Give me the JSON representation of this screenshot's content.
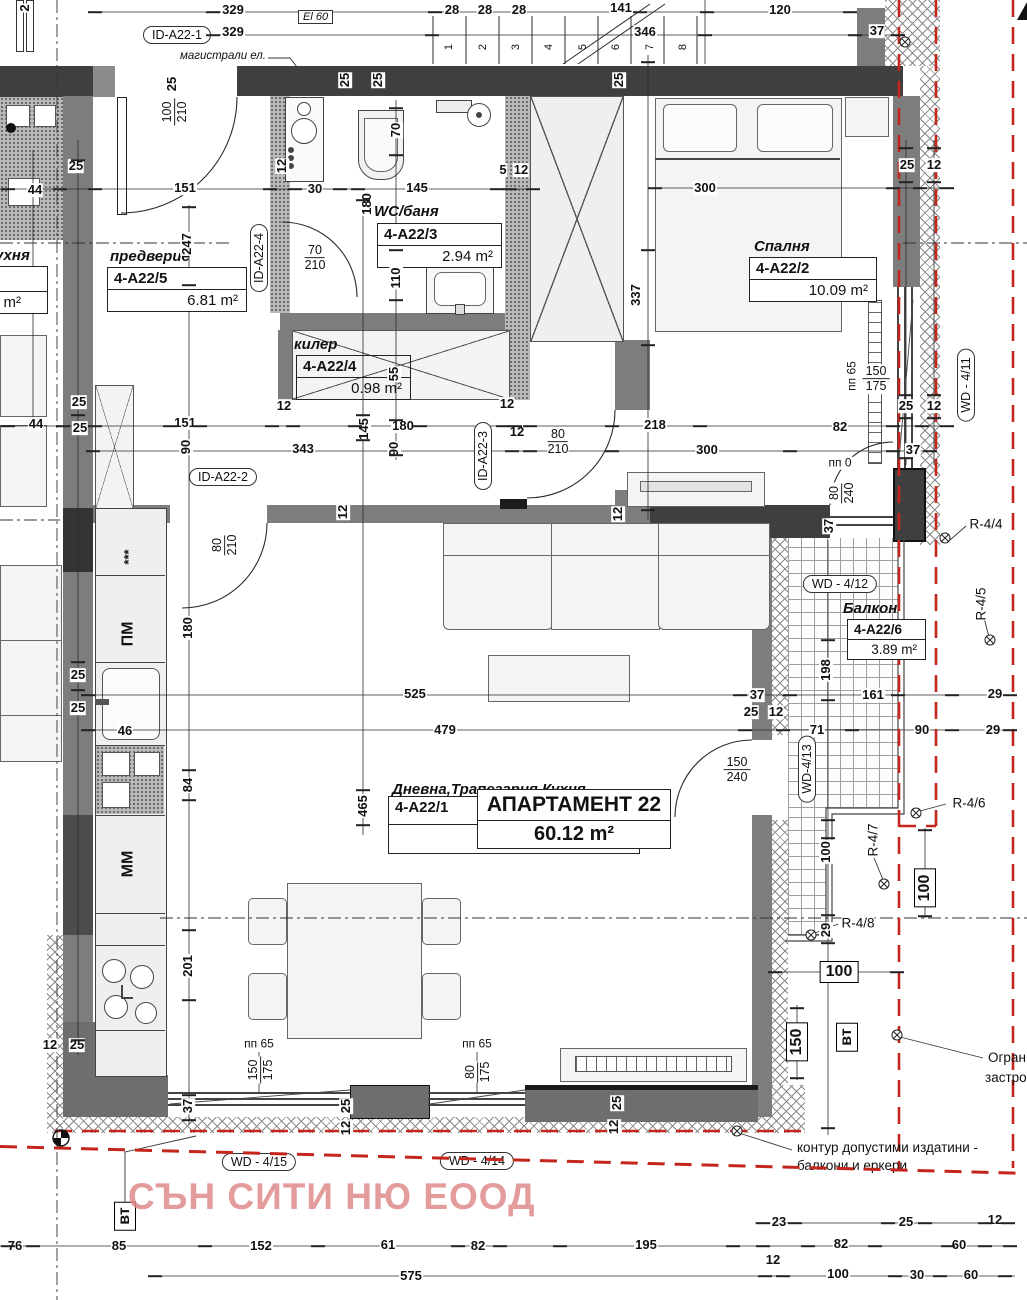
{
  "watermark": "СЪН СИТИ НЮ ЕООД",
  "apartment": {
    "title": "АПАРТАМЕНТ 22",
    "area": "60.12 m²",
    "id": "4-A22/1"
  },
  "rooms": [
    {
      "name": "предверие",
      "id": "4-A22/5",
      "area": "6.81 m²"
    },
    {
      "name": "WC/баня",
      "id": "4-A22/3",
      "area": "2.94 m²"
    },
    {
      "name": "килер",
      "id": "4-A22/4",
      "area": "0.98 m²"
    },
    {
      "name": "Спалня",
      "id": "4-A22/2",
      "area": "10.09 m²"
    },
    {
      "name": "Балкон",
      "id": "4-A22/6",
      "area": "3.89 m²"
    },
    {
      "name": "Дневна,Трапезария,Кухня",
      "id": "4-A22/1",
      "area": ""
    }
  ],
  "neighbor": {
    "name": "Кухня",
    "area": "8 m²"
  },
  "notes": {
    "mains": "магистрали ел.",
    "el": "El 60",
    "contour1": "контур допустими издатини -",
    "contour2": "балкони и еркери",
    "limit1": "Огран",
    "limit2": "застро"
  },
  "colors": {
    "red_boundary": "#c4251d",
    "watermark_pink": "#de8a8a",
    "wall_dark": "#3f3f3f",
    "wall_mid": "#7d7d7d"
  },
  "stairs": {
    "labels": [
      "1",
      "2",
      "3",
      "4",
      "5",
      "6",
      "7",
      "8"
    ],
    "xs": [
      449,
      483,
      516,
      549,
      583,
      616,
      650,
      683
    ],
    "y": 47
  },
  "ovals": [
    {
      "t": "ID-A22-1",
      "x": 177,
      "y": 35
    },
    {
      "t": "ID-A22-2",
      "x": 223,
      "y": 477
    },
    {
      "t": "ID-A22-3",
      "x": 483,
      "y": 456,
      "r": -90
    },
    {
      "t": "ID-A22-4",
      "x": 259,
      "y": 258,
      "r": -90
    },
    {
      "t": "WD - 4/11",
      "x": 966,
      "y": 385,
      "r": -90
    },
    {
      "t": "WD - 4/12",
      "x": 840,
      "y": 584
    },
    {
      "t": "WD-4/13",
      "x": 807,
      "y": 769,
      "r": -90
    },
    {
      "t": "WD - 4/15",
      "x": 259,
      "y": 1162
    },
    {
      "t": "WD - 4/14",
      "x": 477,
      "y": 1161
    }
  ],
  "rmarks": [
    {
      "t": "R-4/4",
      "x": 986,
      "y": 524
    },
    {
      "t": "R-4/5",
      "x": 981,
      "y": 604,
      "r": -90
    },
    {
      "t": "R-4/6",
      "x": 969,
      "y": 803
    },
    {
      "t": "R-4/7",
      "x": 873,
      "y": 840,
      "r": -90
    },
    {
      "t": "R-4/8",
      "x": 858,
      "y": 923
    }
  ],
  "boxes": [
    {
      "t": "100",
      "x": 925,
      "y": 888,
      "r": -90
    },
    {
      "t": "100",
      "x": 839,
      "y": 972
    },
    {
      "t": "150",
      "x": 797,
      "y": 1042,
      "r": -90
    },
    {
      "t": "вт",
      "x": 847,
      "y": 1037,
      "r": -90
    },
    {
      "t": "вт",
      "x": 125,
      "y": 1216,
      "r": -90
    }
  ],
  "fracs": [
    {
      "a": "100",
      "b": "210",
      "x": 175,
      "y": 112,
      "r": -90
    },
    {
      "a": "70",
      "b": "210",
      "x": 315,
      "y": 258
    },
    {
      "a": "80",
      "b": "210",
      "x": 225,
      "y": 545,
      "r": -90
    },
    {
      "a": "80",
      "b": "210",
      "x": 558,
      "y": 442
    },
    {
      "a": "80",
      "b": "240",
      "x": 842,
      "y": 493,
      "r": -90
    },
    {
      "a": "150",
      "b": "175",
      "x": 876,
      "y": 379
    },
    {
      "a": "150",
      "b": "240",
      "x": 737,
      "y": 770
    },
    {
      "a": "150",
      "b": "175",
      "x": 261,
      "y": 1070,
      "r": -90
    },
    {
      "a": "80",
      "b": "175",
      "x": 478,
      "y": 1072,
      "r": -90
    }
  ],
  "dims": [
    {
      "t": "329",
      "x": 233,
      "y": 10
    },
    {
      "t": "329",
      "x": 233,
      "y": 32
    },
    {
      "t": "28",
      "x": 452,
      "y": 10
    },
    {
      "t": "28",
      "x": 485,
      "y": 10
    },
    {
      "t": "28",
      "x": 519,
      "y": 10
    },
    {
      "t": "141",
      "x": 621,
      "y": 8
    },
    {
      "t": "346",
      "x": 645,
      "y": 32
    },
    {
      "t": "120",
      "x": 780,
      "y": 10
    },
    {
      "t": "37",
      "x": 877,
      "y": 31
    },
    {
      "t": "2",
      "x": 25,
      "y": 8,
      "r": -90
    },
    {
      "t": "25",
      "x": 172,
      "y": 84,
      "r": -90
    },
    {
      "t": "25",
      "x": 619,
      "y": 80,
      "r": -90
    },
    {
      "t": "25",
      "x": 345,
      "y": 80,
      "r": -90
    },
    {
      "t": "25",
      "x": 378,
      "y": 80,
      "r": -90
    },
    {
      "t": "70",
      "x": 396,
      "y": 130,
      "r": -90
    },
    {
      "t": "110",
      "x": 396,
      "y": 278,
      "r": -90
    },
    {
      "t": "25",
      "x": 76,
      "y": 166
    },
    {
      "t": "44",
      "x": 35,
      "y": 190
    },
    {
      "t": "151",
      "x": 185,
      "y": 188
    },
    {
      "t": "12",
      "x": 282,
      "y": 166,
      "r": -90
    },
    {
      "t": "30",
      "x": 315,
      "y": 189
    },
    {
      "t": "180",
      "x": 367,
      "y": 204,
      "r": -90
    },
    {
      "t": "145",
      "x": 417,
      "y": 188
    },
    {
      "t": "5",
      "x": 503,
      "y": 170
    },
    {
      "t": "12",
      "x": 521,
      "y": 170
    },
    {
      "t": "247",
      "x": 187,
      "y": 244,
      "r": -90
    },
    {
      "t": "300",
      "x": 705,
      "y": 188
    },
    {
      "t": "25",
      "x": 907,
      "y": 165
    },
    {
      "t": "12",
      "x": 934,
      "y": 165
    },
    {
      "t": "337",
      "x": 636,
      "y": 295,
      "r": -90
    },
    {
      "t": "55",
      "x": 394,
      "y": 374,
      "r": -90
    },
    {
      "t": "12",
      "x": 284,
      "y": 406
    },
    {
      "t": "44",
      "x": 36,
      "y": 424
    },
    {
      "t": "25",
      "x": 79,
      "y": 402
    },
    {
      "t": "25",
      "x": 80,
      "y": 428
    },
    {
      "t": "151",
      "x": 185,
      "y": 423
    },
    {
      "t": "90",
      "x": 186,
      "y": 447,
      "r": -90
    },
    {
      "t": "343",
      "x": 303,
      "y": 449
    },
    {
      "t": "145",
      "x": 364,
      "y": 429,
      "r": -90
    },
    {
      "t": "180",
      "x": 403,
      "y": 426
    },
    {
      "t": "90",
      "x": 394,
      "y": 449,
      "r": -90
    },
    {
      "t": "12",
      "x": 507,
      "y": 404
    },
    {
      "t": "12",
      "x": 517,
      "y": 432
    },
    {
      "t": "218",
      "x": 655,
      "y": 425
    },
    {
      "t": "300",
      "x": 707,
      "y": 450
    },
    {
      "t": "82",
      "x": 840,
      "y": 427
    },
    {
      "t": "25",
      "x": 906,
      "y": 406
    },
    {
      "t": "12",
      "x": 934,
      "y": 406
    },
    {
      "t": "37",
      "x": 913,
      "y": 450
    },
    {
      "t": "пп 0",
      "x": 840,
      "y": 463,
      "s": 1
    },
    {
      "t": "37",
      "x": 829,
      "y": 526,
      "r": -90
    },
    {
      "t": "пп 65",
      "x": 852,
      "y": 376,
      "r": -90,
      "s": 1
    },
    {
      "t": "12",
      "x": 343,
      "y": 512,
      "r": -90
    },
    {
      "t": "12",
      "x": 618,
      "y": 514,
      "r": -90
    },
    {
      "t": "180",
      "x": 188,
      "y": 628,
      "r": -90
    },
    {
      "t": "25",
      "x": 78,
      "y": 675
    },
    {
      "t": "25",
      "x": 78,
      "y": 708
    },
    {
      "t": "46",
      "x": 125,
      "y": 731
    },
    {
      "t": "84",
      "x": 188,
      "y": 785,
      "r": -90
    },
    {
      "t": "201",
      "x": 188,
      "y": 966,
      "r": -90
    },
    {
      "t": "525",
      "x": 415,
      "y": 694
    },
    {
      "t": "479",
      "x": 445,
      "y": 730
    },
    {
      "t": "465",
      "x": 363,
      "y": 806,
      "r": -90
    },
    {
      "t": "37",
      "x": 757,
      "y": 695
    },
    {
      "t": "25",
      "x": 751,
      "y": 712
    },
    {
      "t": "12",
      "x": 776,
      "y": 712
    },
    {
      "t": "161",
      "x": 873,
      "y": 695
    },
    {
      "t": "29",
      "x": 995,
      "y": 694
    },
    {
      "t": "71",
      "x": 817,
      "y": 730
    },
    {
      "t": "90",
      "x": 922,
      "y": 730
    },
    {
      "t": "29",
      "x": 993,
      "y": 730
    },
    {
      "t": "198",
      "x": 826,
      "y": 670,
      "r": -90
    },
    {
      "t": "100",
      "x": 826,
      "y": 852,
      "r": -90
    },
    {
      "t": "29",
      "x": 826,
      "y": 930,
      "r": -90
    },
    {
      "t": "12",
      "x": 50,
      "y": 1045
    },
    {
      "t": "25",
      "x": 77,
      "y": 1045
    },
    {
      "t": "37",
      "x": 188,
      "y": 1106,
      "r": -90
    },
    {
      "t": "пп 65",
      "x": 259,
      "y": 1044,
      "s": 1
    },
    {
      "t": "пп 65",
      "x": 477,
      "y": 1044,
      "s": 1
    },
    {
      "t": "25",
      "x": 346,
      "y": 1106,
      "r": -90
    },
    {
      "t": "12",
      "x": 346,
      "y": 1128,
      "r": -90
    },
    {
      "t": "25",
      "x": 617,
      "y": 1103,
      "r": -90
    },
    {
      "t": "12",
      "x": 614,
      "y": 1127,
      "r": -90
    },
    {
      "t": "23",
      "x": 779,
      "y": 1222
    },
    {
      "t": "25",
      "x": 906,
      "y": 1222
    },
    {
      "t": "12",
      "x": 995,
      "y": 1220
    },
    {
      "t": "76",
      "x": 15,
      "y": 1246
    },
    {
      "t": "85",
      "x": 119,
      "y": 1246
    },
    {
      "t": "152",
      "x": 261,
      "y": 1246
    },
    {
      "t": "61",
      "x": 388,
      "y": 1245
    },
    {
      "t": "82",
      "x": 478,
      "y": 1246
    },
    {
      "t": "195",
      "x": 646,
      "y": 1245
    },
    {
      "t": "12",
      "x": 773,
      "y": 1260
    },
    {
      "t": "82",
      "x": 841,
      "y": 1244
    },
    {
      "t": "60",
      "x": 959,
      "y": 1245
    },
    {
      "t": "575",
      "x": 411,
      "y": 1276
    },
    {
      "t": "100",
      "x": 838,
      "y": 1274
    },
    {
      "t": "30",
      "x": 917,
      "y": 1275
    },
    {
      "t": "60",
      "x": 971,
      "y": 1275
    }
  ],
  "ticks": [
    [
      95,
      12
    ],
    [
      213,
      12
    ],
    [
      435,
      12
    ],
    [
      640,
      12
    ],
    [
      707,
      12
    ],
    [
      850,
      12
    ],
    [
      213,
      35
    ],
    [
      432,
      35
    ],
    [
      705,
      35
    ],
    [
      855,
      35
    ],
    [
      898,
      35
    ],
    [
      8,
      189
    ],
    [
      60,
      189
    ],
    [
      95,
      189
    ],
    [
      270,
      189
    ],
    [
      295,
      189
    ],
    [
      340,
      189
    ],
    [
      358,
      189
    ],
    [
      497,
      189
    ],
    [
      510,
      189
    ],
    [
      533,
      189
    ],
    [
      655,
      188
    ],
    [
      893,
      188
    ],
    [
      920,
      188
    ],
    [
      947,
      188
    ],
    [
      8,
      426
    ],
    [
      63,
      426
    ],
    [
      95,
      426
    ],
    [
      170,
      426
    ],
    [
      200,
      426
    ],
    [
      272,
      426
    ],
    [
      293,
      426
    ],
    [
      355,
      426
    ],
    [
      420,
      426
    ],
    [
      503,
      426
    ],
    [
      515,
      426
    ],
    [
      530,
      426
    ],
    [
      612,
      426
    ],
    [
      700,
      426
    ],
    [
      893,
      426
    ],
    [
      922,
      426
    ],
    [
      947,
      426
    ],
    [
      93,
      451
    ],
    [
      512,
      451
    ],
    [
      530,
      451
    ],
    [
      612,
      451
    ],
    [
      790,
      451
    ],
    [
      893,
      451
    ],
    [
      930,
      451
    ],
    [
      88,
      695
    ],
    [
      740,
      695
    ],
    [
      790,
      695
    ],
    [
      898,
      695
    ],
    [
      952,
      695
    ],
    [
      1010,
      695
    ],
    [
      88,
      730
    ],
    [
      745,
      730
    ],
    [
      783,
      730
    ],
    [
      852,
      730
    ],
    [
      952,
      730
    ],
    [
      1010,
      730
    ],
    [
      763,
      1223
    ],
    [
      795,
      1223
    ],
    [
      888,
      1223
    ],
    [
      925,
      1223
    ],
    [
      985,
      1223
    ],
    [
      1008,
      1223
    ],
    [
      8,
      1246
    ],
    [
      33,
      1246
    ],
    [
      205,
      1246
    ],
    [
      318,
      1246
    ],
    [
      458,
      1246
    ],
    [
      500,
      1246
    ],
    [
      560,
      1246
    ],
    [
      733,
      1246
    ],
    [
      763,
      1246
    ],
    [
      808,
      1246
    ],
    [
      875,
      1246
    ],
    [
      948,
      1246
    ],
    [
      985,
      1246
    ],
    [
      1010,
      1246
    ],
    [
      155,
      1276
    ],
    [
      765,
      1276
    ],
    [
      783,
      1276
    ],
    [
      895,
      1276
    ],
    [
      940,
      1276
    ],
    [
      1005,
      1276
    ],
    [
      78,
      160
    ],
    [
      78,
      415
    ],
    [
      78,
      662
    ],
    [
      78,
      690
    ],
    [
      78,
      1040
    ],
    [
      189,
      207
    ],
    [
      189,
      285
    ],
    [
      189,
      770
    ],
    [
      189,
      800
    ],
    [
      189,
      930
    ],
    [
      189,
      1000
    ],
    [
      189,
      1095
    ],
    [
      189,
      1120
    ],
    [
      363,
      200
    ],
    [
      363,
      415
    ],
    [
      363,
      440
    ],
    [
      363,
      790
    ],
    [
      363,
      825
    ],
    [
      396,
      108
    ],
    [
      396,
      155
    ],
    [
      396,
      250
    ],
    [
      396,
      300
    ],
    [
      396,
      420
    ],
    [
      396,
      455
    ],
    [
      648,
      62
    ],
    [
      648,
      250
    ],
    [
      648,
      345
    ],
    [
      648,
      510
    ],
    [
      828,
      640
    ],
    [
      828,
      700
    ],
    [
      828,
      820
    ],
    [
      828,
      838
    ],
    [
      828,
      915
    ],
    [
      828,
      943
    ],
    [
      828,
      1128
    ],
    [
      906,
      148
    ],
    [
      906,
      182
    ],
    [
      906,
      395
    ],
    [
      906,
      418
    ],
    [
      906,
      458
    ],
    [
      934,
      148
    ],
    [
      934,
      182
    ],
    [
      934,
      395
    ],
    [
      934,
      418
    ],
    [
      925,
      830
    ],
    [
      925,
      916
    ],
    [
      797,
      1008
    ],
    [
      797,
      1078
    ],
    [
      775,
      972
    ],
    [
      897,
      972
    ]
  ]
}
